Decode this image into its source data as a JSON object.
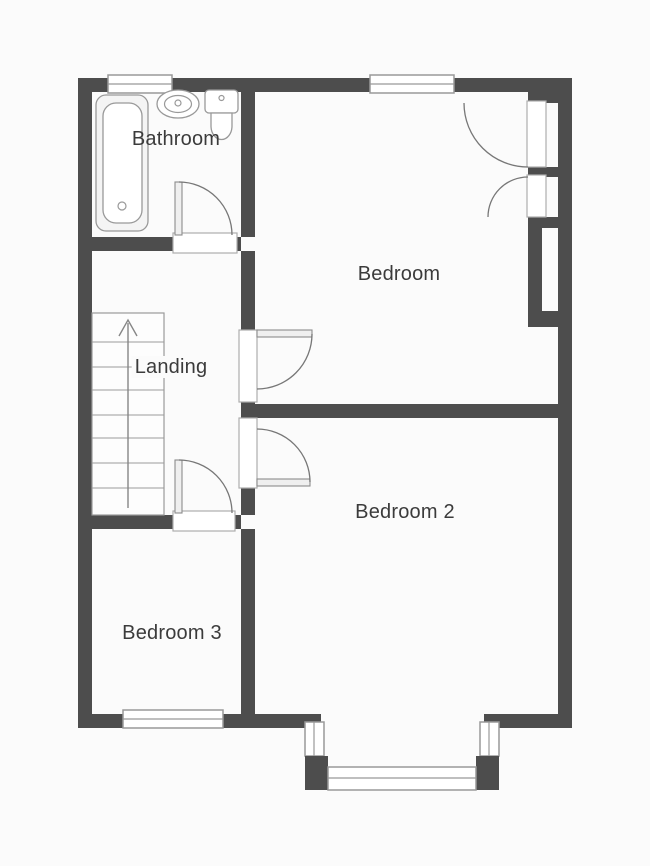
{
  "plan": {
    "rooms": [
      {
        "id": "bathroom",
        "label": "Bathroom"
      },
      {
        "id": "bedroom",
        "label": "Bedroom"
      },
      {
        "id": "landing",
        "label": "Landing"
      },
      {
        "id": "bedroom2",
        "label": "Bedroom 2"
      },
      {
        "id": "bedroom3",
        "label": "Bedroom 3"
      }
    ],
    "stairs": {
      "steps": 8,
      "direction": "up"
    },
    "fixtures": [
      "bathtub",
      "basin",
      "toilet"
    ],
    "features": {
      "bay_window": true,
      "built_in_wardrobe_doors": 2,
      "windows": 6,
      "doors": 4
    },
    "colors": {
      "wall": "#4d4d4d",
      "fixture_line": "#999999",
      "door_arc": "#777777",
      "text": "#3b3b3b",
      "background": "#fbfbfb"
    }
  }
}
